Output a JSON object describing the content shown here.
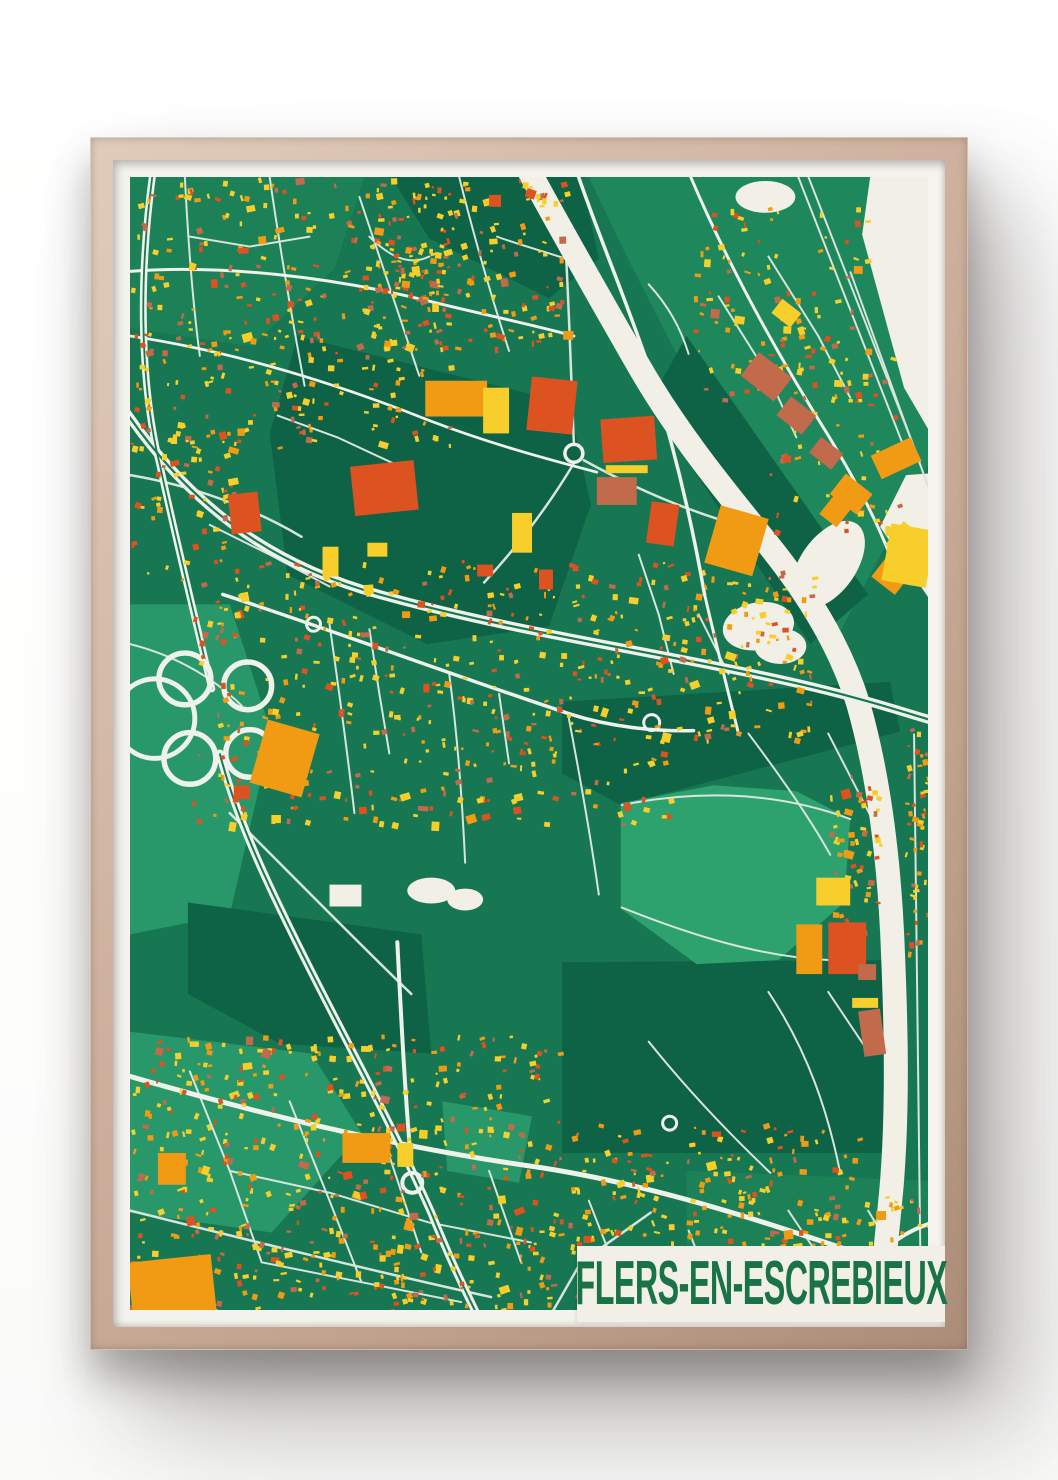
{
  "poster": {
    "title": "FLERS-EN-ESCREBIEUX"
  },
  "palette": {
    "wall": "#ffffff",
    "frame_wood": "#c9ac99",
    "mat": "#f5f3ed",
    "banner_bg": "#f2efe7",
    "title_text": "#1a7249"
  },
  "map": {
    "viewbox": "0 0 800 1140",
    "colors": {
      "base": "#177753",
      "dark": "#0e6246",
      "med": "#1d8158",
      "med2": "#1f875c",
      "light": "#2da26f",
      "light2": "#28986a",
      "cream": "#f2efe7",
      "road_major": "#eef2ea",
      "road_minor": "#d7e5dc",
      "yellow": "#f8cf2a",
      "amber": "#f09b13",
      "redorange": "#dc5220",
      "brick": "#c16a4c",
      "white": "#f2efe7"
    },
    "patches": [
      [
        "0,0 235,0 205,92 122,170 0,152",
        "med"
      ],
      [
        "262,0 452,0 470,82 420,122 300,62",
        "dark"
      ],
      [
        "168,160 440,228 462,330 420,452 298,470 158,400 140,258",
        "dark"
      ],
      [
        "460,0 800,0 800,290 700,480 558,198 498,80",
        "med2"
      ],
      [
        "558,160 740,420 682,470 520,228",
        "dark"
      ],
      [
        "433,528 762,508 772,558 492,632 433,600",
        "dark"
      ],
      [
        "433,790 755,788 755,982 433,982",
        "dark"
      ],
      [
        "0,430 100,430 142,560 100,742 0,762",
        "light2"
      ],
      [
        "0,860 182,882 232,962 142,1062 0,1042",
        "light2"
      ],
      [
        "58,730 292,762 302,882 150,872 58,822",
        "dark"
      ],
      [
        "558,1000 800,1010 800,1140 558,1140",
        "med"
      ],
      [
        "313,930 403,945 390,1012 318,1000",
        "light2"
      ],
      [
        "492,630 585,612 668,618 722,646 716,730 650,788 568,792 492,736",
        "light"
      ]
    ],
    "cream_areas": [
      "742,0 805,0 805,262 776,212 734,58",
      "805,298 805,430 752,352 778,300"
    ],
    "ponds": [
      [
        637,
        20,
        30,
        16,
        0
      ],
      [
        630,
        452,
        36,
        24,
        -10
      ],
      [
        652,
        472,
        26,
        18,
        0
      ],
      [
        302,
        718,
        24,
        13,
        0
      ],
      [
        336,
        727,
        18,
        11,
        0
      ]
    ],
    "canal": {
      "d": "M 398,-10 C 430,50 470,120 510,190 C 550,260 600,320 640,370 C 680,420 712,472 730,530 C 750,600 760,680 764,760 C 768,850 770,930 764,1010 C 758,1080 752,1110 756,1150",
      "width": 24,
      "bulge": [
        700,
        390,
        28,
        50,
        35
      ]
    },
    "railways": [
      [
        "M 668,-5 L 783,290",
        2
      ],
      [
        "M 677,-8 L 792,287",
        2
      ],
      [
        "M 722,95 L 805,325",
        2
      ],
      [
        "M 786,560 L 793,1140",
        2
      ]
    ],
    "roads_major": [
      [
        "M 23,-5 C 10,90 8,200 30,290 C 45,360 62,430 82,515",
        7
      ],
      [
        "M 90,580 C 108,650 142,720 178,792 C 218,872 262,952 302,1042 C 322,1092 335,1118 348,1145",
        8
      ],
      [
        "M -5,235 C 60,330 140,390 250,420 C 400,462 560,482 700,517 C 752,530 780,540 805,547",
        9
      ],
      [
        "M 0,905 C 120,940 260,975 400,995 C 540,1015 665,1062 805,1108",
        5
      ],
      [
        "M 448,-5 C 470,60 500,130 523,200 C 545,270 562,340 576,420",
        3.5
      ],
      [
        "M 576,420 C 590,480 600,520 610,560",
        3
      ],
      [
        "M 268,770 C 272,850 276,930 283,1005",
        4
      ],
      [
        "M 700,1145 C 740,1085 772,1062 805,1052",
        4
      ],
      [
        "M 93,420 C 200,455 320,500 440,540 C 480,553 525,558 565,557",
        3.5
      ],
      [
        "M 0,95 C 90,88 200,100 300,125 C 352,138 402,148 445,160",
        3
      ],
      [
        "M 0,160 C 100,175 200,205 300,245 C 360,268 415,283 468,297",
        2.8
      ],
      [
        "M 560,-5 C 600,90 650,180 700,260 C 730,310 752,352 766,392",
        3
      ]
    ],
    "center_lines": [
      [
        "M -5,235 C 60,330 140,390 250,420 C 400,462 560,482 700,517 C 752,530 780,540 805,547",
        2.2
      ],
      [
        "M 23,-5 C 10,90 8,200 30,290 C 45,360 62,430 82,515",
        1.8
      ],
      [
        "M 90,580 C 108,650 142,720 178,792 C 218,872 262,952 302,1042 C 322,1092 335,1118 348,1145",
        2
      ]
    ],
    "circles": [
      [
        55,
        505,
        26,
        5.5
      ],
      [
        118,
        512,
        24,
        5.5
      ],
      [
        60,
        585,
        26,
        5.5
      ],
      [
        120,
        580,
        24,
        5.5
      ],
      [
        25,
        545,
        40,
        5
      ],
      [
        445,
        278,
        9,
        3.5
      ],
      [
        283,
        1012,
        10,
        4
      ],
      [
        523,
        549,
        8,
        3
      ],
      [
        184,
        450,
        7,
        3
      ],
      [
        541,
        952,
        7,
        3
      ]
    ],
    "roads_minor": [
      [
        "M 55,0 C 58,60 62,120 70,180",
        2
      ],
      [
        "M 140,0 C 150,70 162,140 175,210",
        2
      ],
      [
        "M 230,20 C 250,80 270,140 290,200",
        2
      ],
      [
        "M 330,0 C 345,60 362,120 380,175",
        2
      ],
      [
        "M 435,40 C 440,120 442,200 445,268",
        2.5
      ],
      [
        "M 445,288 C 420,330 392,368 355,408",
        2.5
      ],
      [
        "M 455,285 C 500,310 545,330 592,345",
        2.5
      ],
      [
        "M 200,450 C 210,520 218,580 225,640",
        2
      ],
      [
        "M 320,500 C 328,560 333,625 336,690",
        2
      ],
      [
        "M 440,545 C 452,608 462,665 470,722",
        2
      ],
      [
        "M 100,640 C 160,700 220,762 282,822",
        2.5
      ],
      [
        "M 0,470 C 40,480 80,500 112,532",
        2
      ],
      [
        "M 0,300 C 60,310 122,332 172,362",
        2.5
      ],
      [
        "M 493,632 C 560,618 642,616 722,646",
        2
      ],
      [
        "M 493,735 C 560,762 632,785 702,788",
        2
      ],
      [
        "M 620,560 C 650,600 680,642 702,682",
        2
      ],
      [
        "M 700,560 L 742,642",
        2
      ],
      [
        "M 520,870 C 560,920 600,962 642,1002",
        2
      ],
      [
        "M 640,820 C 680,880 700,942 712,1002",
        2
      ],
      [
        "M 60,900 L 100,1000 L 132,1092",
        2
      ],
      [
        "M 160,930 L 200,1030 L 232,1112",
        2
      ],
      [
        "M 260,985 L 292,1082",
        2
      ],
      [
        "M 360,1000 L 392,1092",
        2
      ],
      [
        "M 460,1030 L 492,1112",
        2
      ],
      [
        "M 560,1060 L 592,1142",
        2
      ],
      [
        "M 100,1000 L 200,1022 L 300,1052 L 402,1072",
        2
      ],
      [
        "M 132,1092 L 232,1112 L 332,1132",
        2
      ],
      [
        "M 0,1040 C 120,1070 240,1100 362,1127",
        2.5
      ],
      [
        "M 420,1148 L 452,1092 L 522,1042",
        2.5
      ],
      [
        "M 60,60 L 120,70 L 180,60",
        2
      ],
      [
        "M 240,60 C 260,80 280,90 300,80",
        2
      ],
      [
        "M 368,60 C 400,72 430,78 462,92",
        2
      ],
      [
        "M 520,108 C 540,130 552,152 560,178",
        2
      ],
      [
        "M 590,120 L 640,200 L 668,262",
        2
      ],
      [
        "M 640,80 L 690,160 L 722,222",
        2
      ],
      [
        "M 240,455 L 250,520 L 260,580",
        2
      ],
      [
        "M 370,520 L 380,590",
        2
      ],
      [
        "M 510,380 L 530,440 L 545,500",
        2
      ],
      [
        "M 570,440 L 600,500",
        2
      ],
      [
        "M 148,240 L 208,262 L 268,290",
        2
      ],
      [
        "M 80,350 L 140,380 L 200,412",
        2
      ],
      [
        "M 700,820 L 740,880",
        2
      ],
      [
        "M 660,1040 L 700,1100",
        2
      ],
      [
        "M 740,1040 L 770,1090",
        2
      ]
    ],
    "clusters": [
      [
        0,
        0,
        330,
        272,
        330,
        1
      ],
      [
        235,
        0,
        205,
        172,
        150,
        2
      ],
      [
        560,
        30,
        180,
        200,
        100,
        3
      ],
      [
        60,
        385,
        480,
        265,
        430,
        4
      ],
      [
        545,
        395,
        140,
        170,
        110,
        5
      ],
      [
        0,
        862,
        432,
        286,
        540,
        6
      ],
      [
        432,
        952,
        300,
        188,
        260,
        7
      ],
      [
        700,
        600,
        52,
        170,
        60,
        8
      ],
      [
        640,
        160,
        130,
        200,
        60,
        9
      ],
      [
        0,
        252,
        112,
        152,
        55,
        10
      ],
      [
        735,
        1025,
        65,
        115,
        40,
        11
      ],
      [
        776,
        555,
        26,
        230,
        50,
        12
      ]
    ],
    "big_buildings": [
      [
        296,
        205,
        62,
        36,
        0,
        "amber"
      ],
      [
        354,
        212,
        26,
        46,
        0,
        "yellow"
      ],
      [
        400,
        203,
        46,
        54,
        6,
        "redorange"
      ],
      [
        473,
        242,
        54,
        44,
        -4,
        "redorange"
      ],
      [
        477,
        290,
        42,
        8,
        0,
        "yellow"
      ],
      [
        468,
        302,
        40,
        28,
        0,
        "brick"
      ],
      [
        520,
        328,
        28,
        42,
        8,
        "redorange"
      ],
      [
        383,
        338,
        20,
        40,
        0,
        "yellow"
      ],
      [
        100,
        318,
        30,
        40,
        -6,
        "redorange"
      ],
      [
        223,
        288,
        64,
        50,
        -6,
        "redorange"
      ],
      [
        193,
        372,
        16,
        30,
        0,
        "yellow"
      ],
      [
        238,
        368,
        20,
        14,
        0,
        "yellow"
      ],
      [
        410,
        395,
        14,
        20,
        0,
        "redorange"
      ],
      [
        348,
        390,
        16,
        12,
        0,
        "redorange"
      ],
      [
        360,
        18,
        12,
        12,
        0,
        "redorange"
      ],
      [
        128,
        552,
        54,
        66,
        16,
        "amber"
      ],
      [
        104,
        612,
        16,
        14,
        0,
        "redorange"
      ],
      [
        583,
        336,
        50,
        60,
        16,
        "amber"
      ],
      [
        617,
        186,
        42,
        30,
        38,
        "brick"
      ],
      [
        652,
        228,
        32,
        24,
        38,
        "brick"
      ],
      [
        684,
        268,
        28,
        20,
        38,
        "brick"
      ],
      [
        706,
        306,
        34,
        26,
        38,
        "amber"
      ],
      [
        701,
        310,
        22,
        40,
        38,
        "amber"
      ],
      [
        746,
        270,
        44,
        26,
        -25,
        "amber"
      ],
      [
        748,
        388,
        30,
        26,
        38,
        "amber"
      ],
      [
        764,
        350,
        22,
        30,
        38,
        "yellow"
      ],
      [
        758,
        352,
        45,
        58,
        10,
        "yellow"
      ],
      [
        646,
        128,
        24,
        18,
        38,
        "yellow"
      ],
      [
        688,
        705,
        34,
        28,
        0,
        "yellow"
      ],
      [
        668,
        752,
        26,
        50,
        0,
        "amber"
      ],
      [
        700,
        750,
        38,
        52,
        0,
        "redorange"
      ],
      [
        730,
        792,
        18,
        16,
        0,
        "brick"
      ],
      [
        733,
        838,
        22,
        46,
        -8,
        "brick"
      ],
      [
        724,
        826,
        26,
        10,
        0,
        "yellow"
      ],
      [
        0,
        1088,
        84,
        56,
        -6,
        "amber"
      ],
      [
        28,
        982,
        28,
        32,
        0,
        "amber"
      ],
      [
        213,
        962,
        48,
        30,
        0,
        "amber"
      ],
      [
        268,
        972,
        16,
        24,
        0,
        "yellow"
      ],
      [
        200,
        712,
        32,
        22,
        0,
        "white"
      ]
    ]
  }
}
